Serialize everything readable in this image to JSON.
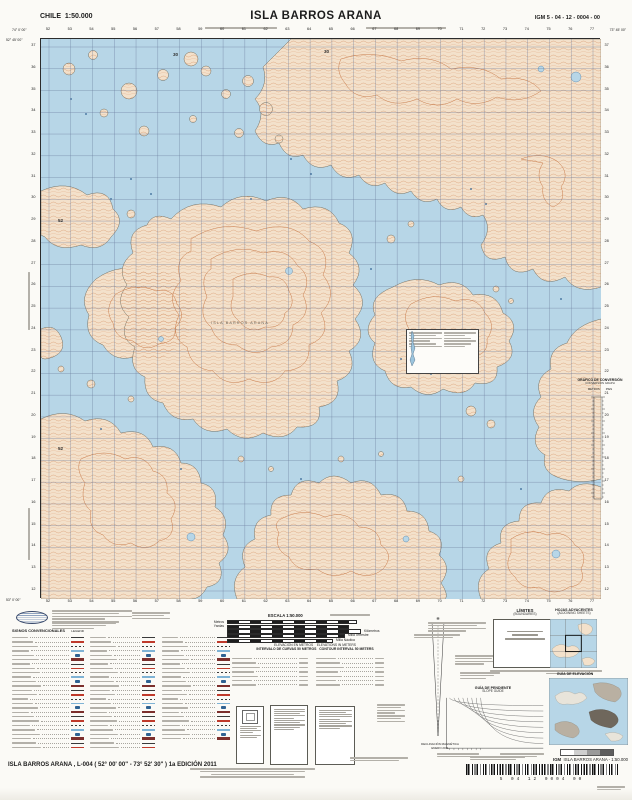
{
  "header": {
    "country": "CHILE",
    "scale": "1:50.000",
    "title": "ISLA BARROS ARANA",
    "sheet_code": "IGM 5 - 04 - 12 - 0004 - 00"
  },
  "map": {
    "island_label": "ISLA BARROS ARANA",
    "corner_coords": {
      "top_left_lon": "74° 0' 00\"",
      "top_left_lat": "52° 45' 00\"",
      "top_right_lon": "73° 45' 00\"",
      "bottom_left_lat": "53° 0' 00\""
    },
    "grid": {
      "eastings": [
        "52",
        "53",
        "54",
        "55",
        "56",
        "57",
        "58",
        "59",
        "60",
        "61",
        "62",
        "63",
        "64",
        "65",
        "66",
        "67",
        "68",
        "69",
        "70",
        "71",
        "72",
        "73",
        "74",
        "75",
        "76",
        "77"
      ],
      "northings": [
        "37",
        "36",
        "35",
        "34",
        "33",
        "32",
        "31",
        "30",
        "29",
        "28",
        "27",
        "26",
        "25",
        "24",
        "23",
        "22",
        "21",
        "20",
        "19",
        "18",
        "17",
        "16",
        "15",
        "14",
        "13",
        "12"
      ]
    },
    "inmap_labels": [
      {
        "text": "30",
        "x": 132,
        "y": 14
      },
      {
        "text": "30",
        "x": 283,
        "y": 11
      },
      {
        "text": "52",
        "x": 17,
        "y": 180
      },
      {
        "text": "52",
        "x": 17,
        "y": 408
      }
    ]
  },
  "marginalia": {
    "conversion_graph": {
      "title": "GRÁFICO DE CONVERSIÓN",
      "subtitle": "CONVERSION GRAPH",
      "unit_left": "METROS",
      "unit_right": "PIES"
    },
    "signos_title": "SIGNOS CONVENCIONALES",
    "signos_title_en": "LEGEND",
    "scalebar": {
      "title": "ESCALA 1:50.000",
      "rows": [
        {
          "label": "Metros",
          "side": "left",
          "w": 128
        },
        {
          "label": "Yardas",
          "side": "left",
          "w": 120
        },
        {
          "label": "Kilómetros",
          "side": "right",
          "w": 132
        },
        {
          "label": "Milla Terrestre",
          "side": "right",
          "w": 116
        },
        {
          "label": "Milla Náutica",
          "side": "right",
          "w": 104
        }
      ]
    },
    "elevation_note": {
      "es": "ELEVACIÓN EN METROS",
      "en": "ELEVATIONS IN METERS",
      "interval_es": "INTERVALO DE CURVAS 50 METROS",
      "interval_en": "CONTOUR INTERVAL 50 METERS"
    },
    "declination": {
      "label": "DECLINACIÓN MAGNÉTICA",
      "date": "ENERO 2011"
    },
    "limites": {
      "title": "LÍMITES",
      "subtitle": "(BOUNDARIES)"
    },
    "hojas": {
      "title": "HOJAS ADYACENTES",
      "subtitle": "(ADJOINING SHEETS)"
    },
    "guia_elevacion": {
      "title": "GUÍA DE ELEVACIÓN"
    },
    "guia_pendiente": {
      "title": "GUÍA DE PENDIENTE",
      "subtitle": "SLOPE GUIDE"
    }
  },
  "footer": {
    "title_line": "ISLA BARROS ARANA , L-004 ( 52° 00' 00\" - 73° 52' 30\" ) 1a EDICIÓN 2011",
    "igm_abbr": "IGM",
    "product_label": "ISLA BARROS ARANA - 1:50.000",
    "barcode_digits": "5 04 12 0004 00"
  },
  "colors": {
    "water": "#b7d6e7",
    "land": "#f3e1cb",
    "contour": "#cd8455",
    "grid_line": "#5f6f92"
  }
}
